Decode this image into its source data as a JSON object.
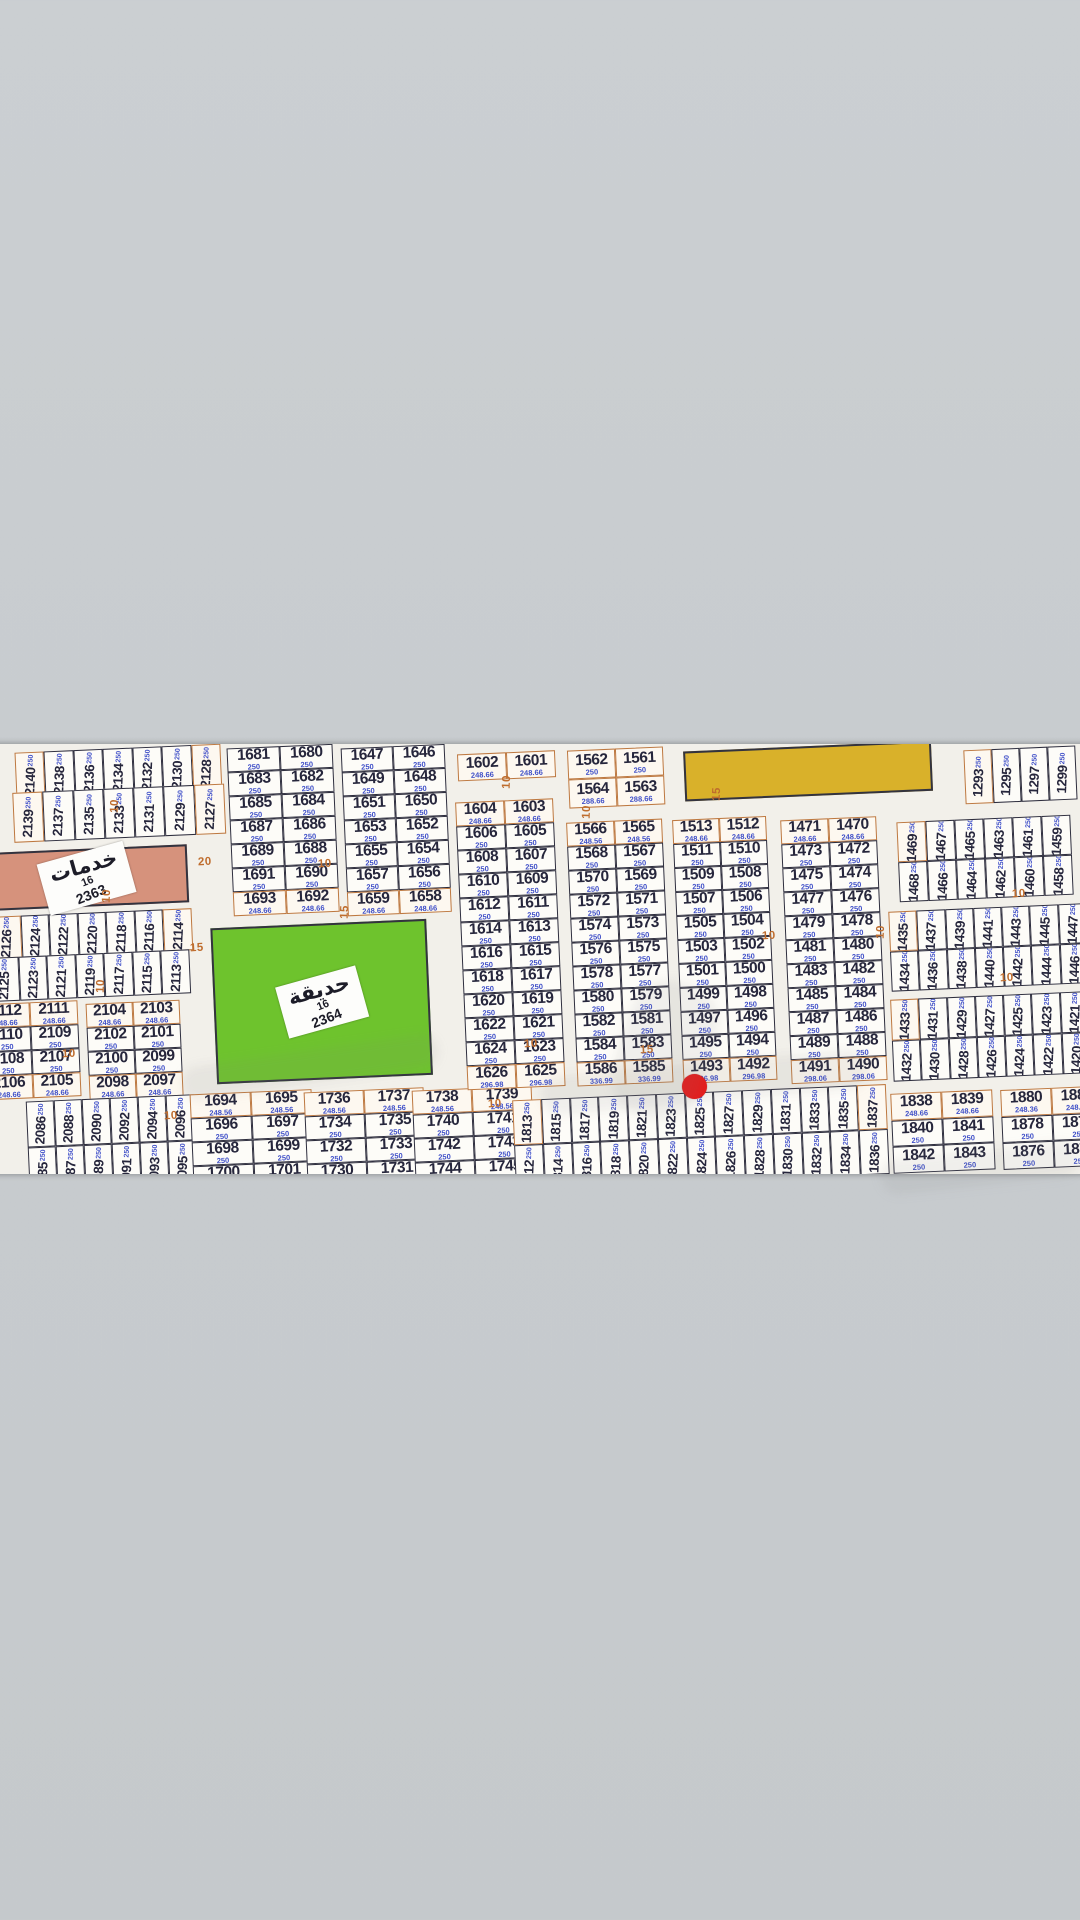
{
  "scene": {
    "background_color": "#c8cccf",
    "paper_color": "#f2f0ea",
    "red_dot_color": "#ee1111",
    "road_label_color": "#bf6d2e",
    "plot_number_color": "#26263c",
    "plot_area_color": "#4050c8"
  },
  "map": {
    "service_block": {
      "label": "خدمات",
      "number": "16",
      "plot_id": "2363",
      "color": "#d6927c"
    },
    "park_block": {
      "label": "حديقة",
      "number": "16",
      "plot_id": "2364",
      "color": "#6ec32d"
    },
    "yellow_block": {
      "color": "#d9b12a"
    },
    "marker": {
      "plot": "1825"
    },
    "road_labels": [
      {
        "text": "10",
        "x": 108,
        "y": 800,
        "v": true
      },
      {
        "text": "10",
        "x": 100,
        "y": 890,
        "v": true
      },
      {
        "text": "20",
        "x": 198,
        "y": 856,
        "v": false
      },
      {
        "text": "15",
        "x": 190,
        "y": 942,
        "v": false
      },
      {
        "text": "10",
        "x": 94,
        "y": 980,
        "v": true
      },
      {
        "text": "10",
        "x": 62,
        "y": 1048,
        "v": false
      },
      {
        "text": "10",
        "x": 164,
        "y": 1110,
        "v": false
      },
      {
        "text": "10",
        "x": 318,
        "y": 858,
        "v": false
      },
      {
        "text": "15",
        "x": 338,
        "y": 906,
        "v": true
      },
      {
        "text": "10",
        "x": 500,
        "y": 776,
        "v": true
      },
      {
        "text": "10",
        "x": 524,
        "y": 1038,
        "v": false
      },
      {
        "text": "15",
        "x": 640,
        "y": 1044,
        "v": false
      },
      {
        "text": "10",
        "x": 580,
        "y": 806,
        "v": true
      },
      {
        "text": "10",
        "x": 762,
        "y": 930,
        "v": false
      },
      {
        "text": "15",
        "x": 710,
        "y": 788,
        "v": true
      },
      {
        "text": "10",
        "x": 874,
        "y": 926,
        "v": true
      },
      {
        "text": "10",
        "x": 1012,
        "y": 888,
        "v": false
      },
      {
        "text": "10",
        "x": 1000,
        "y": 972,
        "v": false
      },
      {
        "text": "10",
        "x": 488,
        "y": 1098,
        "v": false
      }
    ],
    "blocks": [
      {
        "id": "s2140",
        "type": "vstrip",
        "cells": [
          "2140",
          "2138",
          "2136",
          "2134",
          "2132",
          "2130",
          "2128"
        ],
        "area": "250",
        "edge_cells": [
          0,
          6
        ]
      },
      {
        "id": "s2139",
        "type": "vstrip",
        "cells": [
          "2139",
          "2137",
          "2135",
          "2133",
          "2131",
          "2129",
          "2127"
        ],
        "area": "250",
        "edge_cells": [
          0,
          6
        ]
      },
      {
        "id": "s2126",
        "type": "vstrip",
        "cells": [
          "2126",
          "2124",
          "2122",
          "2120",
          "2118",
          "2116",
          "2114"
        ],
        "area": "250",
        "edge_cells": [
          0,
          6
        ]
      },
      {
        "id": "s2125",
        "type": "vstrip",
        "cells": [
          "2125",
          "2123",
          "2121",
          "2119",
          "2117",
          "2115",
          "2113"
        ],
        "area": "250",
        "edge_cells": []
      },
      {
        "id": "g2112",
        "type": "grid",
        "rows": [
          [
            "2112",
            "2111"
          ],
          [
            "2110",
            "2109"
          ],
          [
            "2108",
            "2107"
          ],
          [
            "2106",
            "2105"
          ]
        ],
        "areas": [
          "248.66",
          "250",
          "250",
          "248.66"
        ],
        "edge_rows": [
          0,
          3
        ]
      },
      {
        "id": "g2104",
        "type": "grid",
        "rows": [
          [
            "2104",
            "2103"
          ],
          [
            "2102",
            "2101"
          ],
          [
            "2100",
            "2099"
          ],
          [
            "2098",
            "2097"
          ]
        ],
        "areas": [
          "248.66",
          "250",
          "250",
          "248.66"
        ],
        "edge_rows": [
          0,
          3
        ]
      },
      {
        "id": "s2086",
        "type": "vstrip2",
        "top": [
          "2086",
          "2088",
          "2090",
          "2092",
          "2094",
          "2096"
        ],
        "bottom": [
          "2085",
          "2087",
          "2089",
          "2091",
          "2093",
          "2095"
        ],
        "area": "250",
        "edge_cells": []
      },
      {
        "id": "g1681",
        "type": "grid",
        "rows": [
          [
            "1681",
            "1680"
          ],
          [
            "1683",
            "1682"
          ],
          [
            "1685",
            "1684"
          ],
          [
            "1687",
            "1686"
          ],
          [
            "1689",
            "1688"
          ],
          [
            "1691",
            "1690"
          ],
          [
            "1693",
            "1692"
          ]
        ],
        "areas": [
          "250",
          "250",
          "250",
          "250",
          "250",
          "250",
          "248.66"
        ],
        "edge_rows": [
          6
        ]
      },
      {
        "id": "g1647",
        "type": "grid",
        "rows": [
          [
            "1647",
            "1646"
          ],
          [
            "1649",
            "1648"
          ],
          [
            "1651",
            "1650"
          ],
          [
            "1653",
            "1652"
          ],
          [
            "1655",
            "1654"
          ],
          [
            "1657",
            "1656"
          ],
          [
            "1659",
            "1658"
          ]
        ],
        "areas": [
          "250",
          "250",
          "250",
          "250",
          "250",
          "250",
          "248.66"
        ],
        "edge_rows": [
          6
        ]
      },
      {
        "id": "g1694",
        "type": "grid",
        "rows": [
          [
            "1694",
            "1695"
          ],
          [
            "1696",
            "1697"
          ],
          [
            "1698",
            "1699"
          ],
          [
            "1700",
            "1701"
          ]
        ],
        "areas": [
          "248.56",
          "250",
          "250",
          "250"
        ],
        "edge_rows": [
          0
        ]
      },
      {
        "id": "g1736",
        "type": "grid",
        "rows": [
          [
            "1736",
            "1737"
          ],
          [
            "1734",
            "1735"
          ],
          [
            "1732",
            "1733"
          ],
          [
            "1730",
            "1731"
          ]
        ],
        "areas": [
          "248.56",
          "250",
          "250",
          "250"
        ],
        "edge_rows": [
          0
        ]
      },
      {
        "id": "g1738",
        "type": "grid",
        "rows": [
          [
            "1738",
            "1739"
          ],
          [
            "1740",
            "1741"
          ],
          [
            "1742",
            "1743"
          ],
          [
            "1744",
            "1745"
          ]
        ],
        "areas": [
          "248.56",
          "250",
          "250",
          "250"
        ],
        "edge_rows": [
          0
        ]
      },
      {
        "id": "g1602",
        "type": "grid",
        "rows": [
          [
            "1602",
            "1601"
          ]
        ],
        "areas": [
          "248.66"
        ],
        "edge_rows": [
          0
        ]
      },
      {
        "id": "g1604",
        "type": "grid",
        "rows": [
          [
            "1604",
            "1603"
          ],
          [
            "1606",
            "1605"
          ],
          [
            "1608",
            "1607"
          ],
          [
            "1610",
            "1609"
          ],
          [
            "1612",
            "1611"
          ],
          [
            "1614",
            "1613"
          ],
          [
            "1616",
            "1615"
          ],
          [
            "1618",
            "1617"
          ],
          [
            "1620",
            "1619"
          ],
          [
            "1622",
            "1621"
          ],
          [
            "1624",
            "1623"
          ],
          [
            "1626",
            "1625"
          ]
        ],
        "areas": [
          "248.66",
          "250",
          "250",
          "250",
          "250",
          "250",
          "250",
          "250",
          "250",
          "250",
          "250",
          "296.98"
        ],
        "edge_rows": [
          0,
          11
        ]
      },
      {
        "id": "g1562",
        "type": "grid",
        "rows": [
          [
            "1562",
            "1561"
          ],
          [
            "1564",
            "1563"
          ]
        ],
        "areas": [
          "250",
          "288.66"
        ],
        "edge_rows": [
          0,
          1
        ]
      },
      {
        "id": "g1566",
        "type": "grid",
        "rows": [
          [
            "1566",
            "1565"
          ],
          [
            "1568",
            "1567"
          ],
          [
            "1570",
            "1569"
          ],
          [
            "1572",
            "1571"
          ],
          [
            "1574",
            "1573"
          ],
          [
            "1576",
            "1575"
          ],
          [
            "1578",
            "1577"
          ],
          [
            "1580",
            "1579"
          ],
          [
            "1582",
            "1581"
          ],
          [
            "1584",
            "1583"
          ],
          [
            "1586",
            "1585"
          ]
        ],
        "areas": [
          "248.56",
          "250",
          "250",
          "250",
          "250",
          "250",
          "250",
          "250",
          "250",
          "250",
          "336.99"
        ],
        "edge_rows": [
          0,
          10
        ]
      },
      {
        "id": "g1513",
        "type": "grid",
        "rows": [
          [
            "1513",
            "1512"
          ],
          [
            "1511",
            "1510"
          ],
          [
            "1509",
            "1508"
          ],
          [
            "1507",
            "1506"
          ],
          [
            "1505",
            "1504"
          ],
          [
            "1503",
            "1502"
          ],
          [
            "1501",
            "1500"
          ],
          [
            "1499",
            "1498"
          ],
          [
            "1497",
            "1496"
          ],
          [
            "1495",
            "1494"
          ],
          [
            "1493",
            "1492"
          ]
        ],
        "areas": [
          "248.66",
          "250",
          "250",
          "250",
          "250",
          "250",
          "250",
          "250",
          "250",
          "250",
          "296.98"
        ],
        "edge_rows": [
          0,
          10
        ]
      },
      {
        "id": "g1471",
        "type": "grid",
        "rows": [
          [
            "1471",
            "1470"
          ],
          [
            "1473",
            "1472"
          ],
          [
            "1475",
            "1474"
          ],
          [
            "1477",
            "1476"
          ],
          [
            "1479",
            "1478"
          ],
          [
            "1481",
            "1480"
          ],
          [
            "1483",
            "1482"
          ],
          [
            "1485",
            "1484"
          ],
          [
            "1487",
            "1486"
          ],
          [
            "1489",
            "1488"
          ],
          [
            "1491",
            "1490"
          ]
        ],
        "areas": [
          "248.66",
          "250",
          "250",
          "250",
          "250",
          "250",
          "250",
          "250",
          "250",
          "250",
          "298.06"
        ],
        "edge_rows": [
          0,
          10
        ]
      },
      {
        "id": "s1293",
        "type": "vstrip",
        "cells": [
          "1293",
          "1295",
          "1297",
          "1299"
        ],
        "area": "250",
        "edge_cells": [
          0
        ]
      },
      {
        "id": "s1469",
        "type": "vstrip2",
        "top": [
          "1469",
          "1467",
          "1465",
          "1463",
          "1461",
          "1459"
        ],
        "bottom": [
          "1468",
          "1466",
          "1464",
          "1462",
          "1460",
          "1458"
        ],
        "area": "250",
        "edge_cells": [
          0
        ]
      },
      {
        "id": "s1435",
        "type": "vstrip2",
        "top": [
          "1435",
          "1437",
          "1439",
          "1441",
          "1443",
          "1445",
          "1447"
        ],
        "bottom": [
          "1434",
          "1436",
          "1438",
          "1440",
          "1442",
          "1444",
          "1446"
        ],
        "area": "250",
        "edge_cells": [
          0
        ]
      },
      {
        "id": "s1433",
        "type": "vstrip2",
        "top": [
          "1433",
          "1431",
          "1429",
          "1427",
          "1425",
          "1423",
          "1421"
        ],
        "bottom": [
          "1432",
          "1430",
          "1428",
          "1426",
          "1424",
          "1422",
          "1420"
        ],
        "area": "250",
        "edge_cells": [
          0
        ]
      },
      {
        "id": "s1813",
        "type": "vstrip2",
        "top": [
          "1813",
          "1815",
          "1817",
          "1819",
          "1821",
          "1823",
          "1825",
          "1827",
          "1829",
          "1831",
          "1833",
          "1835",
          "1837"
        ],
        "bottom": [
          "1812",
          "1814",
          "1816",
          "1818",
          "1820",
          "1822",
          "1824",
          "1826",
          "1828",
          "1830",
          "1832",
          "1834",
          "1836"
        ],
        "area": "250",
        "edge_cells": [
          0,
          12
        ]
      },
      {
        "id": "g1838",
        "type": "grid",
        "rows": [
          [
            "1838",
            "1839"
          ],
          [
            "1840",
            "1841"
          ],
          [
            "1842",
            "1843"
          ]
        ],
        "areas": [
          "248.66",
          "250",
          "250"
        ],
        "edge_rows": [
          0
        ]
      },
      {
        "id": "g1880",
        "type": "grid",
        "rows": [
          [
            "1880",
            "1881"
          ],
          [
            "1878",
            "1879"
          ],
          [
            "1876",
            "1877"
          ]
        ],
        "areas": [
          "248.36",
          "250",
          "250"
        ],
        "edge_rows": [
          0
        ]
      }
    ]
  }
}
